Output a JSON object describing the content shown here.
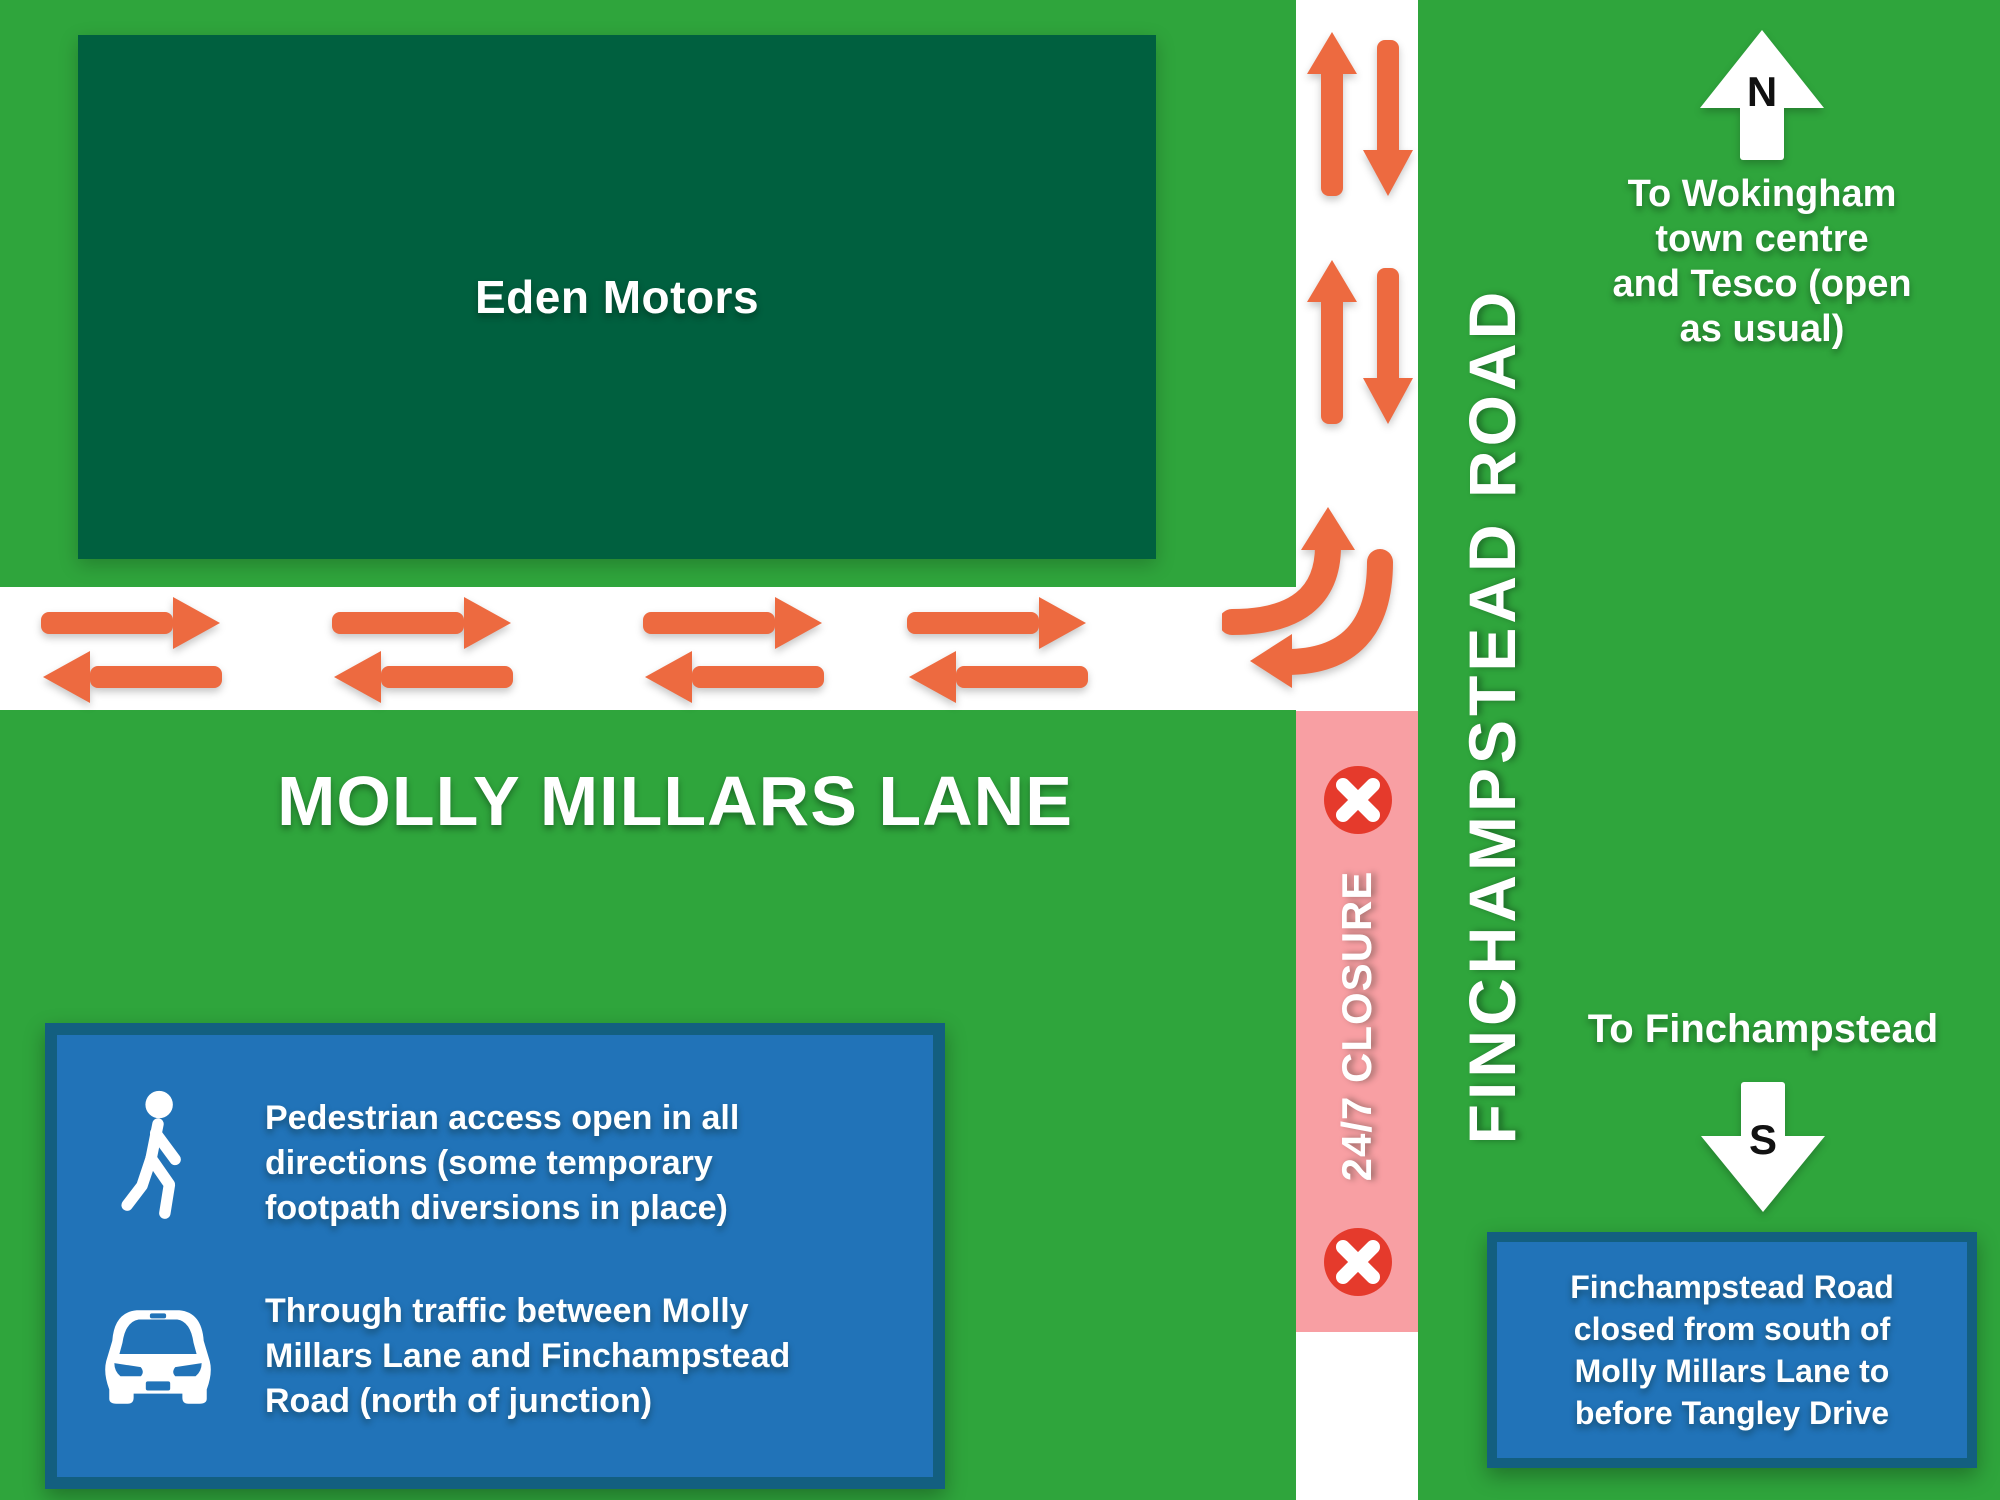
{
  "colors": {
    "bg-green": "#2fa53c",
    "building-green": "#00603f",
    "road-white": "#ffffff",
    "closure-pink": "#f89fa3",
    "arrow-orange": "#ed6a40",
    "closed-red": "#e53a2c",
    "box-blue": "#2173b8",
    "box-border-blue": "#135f80",
    "text-white": "#ffffff",
    "text-black": "#111111"
  },
  "map": {
    "building_label": "Eden Motors",
    "horizontal_road_label": "MOLLY MILLARS LANE",
    "vertical_road_label": "FINCHAMPSTEAD ROAD",
    "closure_label": "24/7 CLOSURE"
  },
  "compass": {
    "north_letter": "N",
    "south_letter": "S"
  },
  "directions": {
    "north_text": "To Wokingham\ntown centre\nand Tesco (open\nas usual)",
    "south_text": "To Finchampstead"
  },
  "legend": {
    "pedestrian_note": "Pedestrian access open in all\ndirections (some temporary\nfootpath diversions in place)",
    "traffic_note": "Through traffic between Molly\nMillars Lane and Finchampstead\nRoad (north of junction)"
  },
  "closure_box": {
    "text": "Finchampstead Road\nclosed from south of\nMolly Millars Lane to\nbefore Tangley Drive"
  },
  "icons": {
    "north": "up-arrow",
    "south": "down-arrow",
    "closed": "x-in-red-circle",
    "pedestrian": "walking-person",
    "car": "car-front",
    "two_way_traffic": "paired-opposite-arrows",
    "junction_turns": "curved-turn-arrows"
  }
}
